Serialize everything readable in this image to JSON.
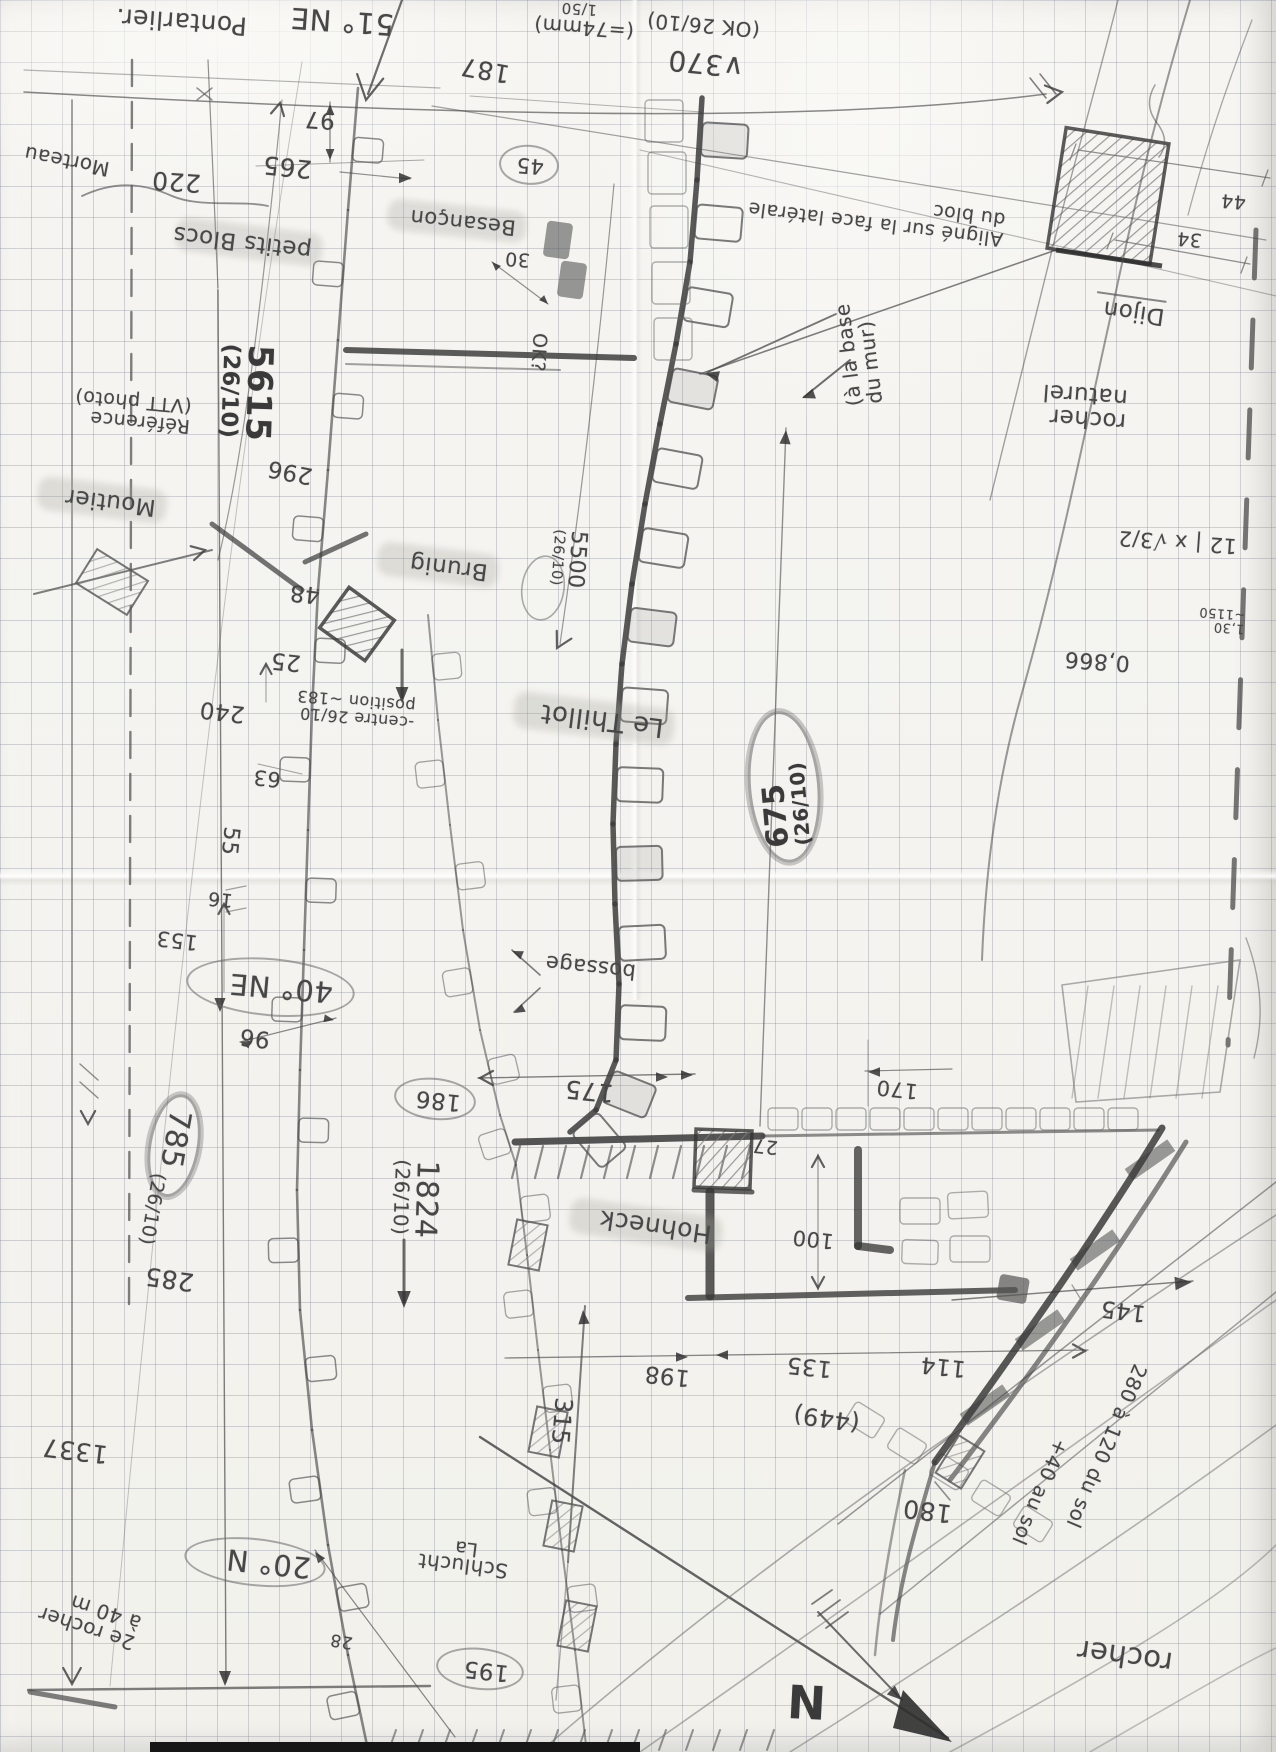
{
  "page": {
    "width": 1276,
    "height": 1752,
    "paper_color": "#f4f3ef",
    "grid_color": "rgba(122,130,146,0.32)",
    "pencil_color": "#474747",
    "description_labels_language": "fr"
  },
  "labels": [
    {
      "name": "label-pontarlier",
      "text": "Pontarlier.",
      "x": 52,
      "y": 6,
      "w": 195,
      "rot": 184,
      "size": 25
    },
    {
      "name": "label-bearing-51ne",
      "text": "51° NE",
      "x": 286,
      "y": 6,
      "w": 108,
      "rot": 184,
      "size": 29
    },
    {
      "name": "dim-187",
      "text": "187",
      "x": 452,
      "y": 56,
      "w": 58,
      "rot": 190,
      "size": 25
    },
    {
      "name": "dim-97",
      "text": "97",
      "x": 293,
      "y": 106,
      "w": 42,
      "rot": 184,
      "size": 23
    },
    {
      "name": "dim-265",
      "text": "265",
      "x": 252,
      "y": 153,
      "w": 60,
      "rot": 186,
      "size": 25
    },
    {
      "name": "dim-220",
      "text": "220",
      "x": 143,
      "y": 168,
      "w": 58,
      "rot": 184,
      "size": 25
    },
    {
      "name": "label-morteau",
      "text": "Morteau",
      "x": 18,
      "y": 150,
      "w": 92,
      "rot": 191,
      "size": 20
    },
    {
      "name": "label-petits-blocs",
      "text": "petits Blocs",
      "x": 180,
      "y": 230,
      "w": 126,
      "rot": 187,
      "size": 23,
      "cls": "hl"
    },
    {
      "name": "label-besancon",
      "text": "Besançon",
      "x": 392,
      "y": 210,
      "w": 118,
      "rot": 186,
      "size": 21,
      "cls": "hl"
    },
    {
      "name": "note-scale-150",
      "text": "1/50",
      "x": 549,
      "y": 0,
      "w": 48,
      "rot": 184,
      "size": 15
    },
    {
      "name": "note-74mm",
      "text": "(=74mm)",
      "x": 522,
      "y": 17,
      "w": 112,
      "rot": 184,
      "size": 20
    },
    {
      "name": "note-ok-2610",
      "text": "(OK 26/10)",
      "x": 628,
      "y": 14,
      "w": 132,
      "rot": 185,
      "size": 20
    },
    {
      "name": "dim-370",
      "text": "∨370",
      "x": 646,
      "y": 48,
      "w": 98,
      "rot": 186,
      "size": 28
    },
    {
      "name": "dim-45",
      "text": "45",
      "x": 499,
      "y": 145,
      "w": 30,
      "rot": 184,
      "size": 21,
      "cls": "circ"
    },
    {
      "name": "dim-30",
      "text": "30",
      "x": 494,
      "y": 248,
      "w": 36,
      "rot": 184,
      "size": 19
    },
    {
      "name": "note-aligne",
      "lines": [
        "Aligné sur la face latérale",
        "du bloc"
      ],
      "x": 775,
      "y": 195,
      "w": 230,
      "rot": 187,
      "size": 19
    },
    {
      "name": "note-a-la-base",
      "lines": [
        "(à la base",
        "du mur)"
      ],
      "x": 795,
      "y": 322,
      "w": 125,
      "rot": -97,
      "size": 20
    },
    {
      "name": "label-dijon",
      "text": "Dijon",
      "x": 1095,
      "y": 296,
      "w": 70,
      "rot": 188,
      "size": 23,
      "cls": "und"
    },
    {
      "name": "dim-44",
      "text": "44",
      "x": 1212,
      "y": 190,
      "w": 34,
      "rot": 185,
      "size": 19
    },
    {
      "name": "dim-34",
      "text": "34",
      "x": 1168,
      "y": 228,
      "w": 34,
      "rot": 185,
      "size": 19
    },
    {
      "name": "label-rocher-naturel",
      "lines": [
        "rocher",
        "naturel"
      ],
      "x": 992,
      "y": 380,
      "w": 135,
      "rot": 184,
      "size": 23
    },
    {
      "name": "calc-sqrt3-over-2",
      "text": "12 | x √3/2",
      "x": 1112,
      "y": 530,
      "w": 125,
      "rot": 184,
      "size": 21
    },
    {
      "name": "calc-1150",
      "lines": [
        "1,30",
        "~1150"
      ],
      "x": 1185,
      "y": 606,
      "w": 60,
      "rot": 184,
      "size": 13
    },
    {
      "name": "calc-0866",
      "text": "0,866",
      "x": 1055,
      "y": 648,
      "w": 75,
      "rot": 184,
      "size": 22
    },
    {
      "name": "dim-5615",
      "lines": [
        "5615",
        "(26/10)"
      ],
      "x": 186,
      "y": 375,
      "w": 120,
      "rot": 92,
      "size": 34,
      "cls": "b",
      "sub": true
    },
    {
      "name": "note-reference-photo",
      "lines": [
        "Référence",
        "(VTT photo)"
      ],
      "x": 56,
      "y": 390,
      "w": 135,
      "rot": 185,
      "size": 19
    },
    {
      "name": "dim-296",
      "text": "296",
      "x": 258,
      "y": 458,
      "w": 55,
      "rot": 191,
      "size": 23
    },
    {
      "name": "label-moutier",
      "text": "Moutier",
      "x": 42,
      "y": 488,
      "w": 108,
      "rot": 187,
      "size": 23,
      "cls": "hl"
    },
    {
      "name": "dim-48",
      "text": "48",
      "x": 280,
      "y": 580,
      "w": 40,
      "rot": 186,
      "size": 23
    },
    {
      "name": "label-brunig",
      "text": "Brunig",
      "x": 382,
      "y": 553,
      "w": 100,
      "rot": 187,
      "size": 23,
      "cls": "hl"
    },
    {
      "name": "dim-25",
      "text": "25",
      "x": 263,
      "y": 648,
      "w": 38,
      "rot": 186,
      "size": 23
    },
    {
      "name": "note-centre-position",
      "lines": [
        "-centre 26/10",
        "position ~183"
      ],
      "x": 290,
      "y": 692,
      "w": 125,
      "rot": 185,
      "size": 16
    },
    {
      "name": "dim-240",
      "text": "240",
      "x": 190,
      "y": 698,
      "w": 55,
      "rot": 187,
      "size": 23
    },
    {
      "name": "dim-63",
      "text": "63",
      "x": 243,
      "y": 766,
      "w": 38,
      "rot": 186,
      "size": 21
    },
    {
      "name": "dim-55",
      "text": "55",
      "x": 205,
      "y": 838,
      "w": 46,
      "rot": 96,
      "size": 22
    },
    {
      "name": "dim-16",
      "text": "16",
      "x": 199,
      "y": 888,
      "w": 34,
      "rot": 186,
      "size": 19
    },
    {
      "name": "dim-153",
      "text": "153",
      "x": 146,
      "y": 928,
      "w": 52,
      "rot": 187,
      "size": 21
    },
    {
      "name": "note-ok-q",
      "text": "OK?",
      "x": 508,
      "y": 352,
      "w": 58,
      "rot": 94,
      "size": 19
    },
    {
      "name": "dim-5500",
      "lines": [
        "5500",
        "(26/10)"
      ],
      "x": 519,
      "y": 559,
      "w": 96,
      "rot": 94,
      "size": 22,
      "sub": true
    },
    {
      "name": "label-le-thillot",
      "text": "Le Thillot",
      "x": 518,
      "y": 705,
      "w": 140,
      "rot": 187,
      "size": 26,
      "cls": "hl"
    },
    {
      "name": "dim-675",
      "lines": [
        "675",
        "(26/10)"
      ],
      "x": 708,
      "y": 751,
      "w": 120,
      "rot": -95,
      "size": 30,
      "cls": "circ heavy b",
      "sub": true
    },
    {
      "name": "dim-96",
      "text": "96",
      "x": 228,
      "y": 1024,
      "w": 42,
      "rot": 187,
      "size": 23
    },
    {
      "name": "label-bearing-40ne",
      "text": "40° NE",
      "x": 186,
      "y": 958,
      "w": 125,
      "rot": 185,
      "size": 29,
      "cls": "circ big"
    },
    {
      "name": "dim-785",
      "text": "785",
      "x": 122,
      "y": 1120,
      "w": 72,
      "rot": 100,
      "size": 30,
      "cls": "circ heavy"
    },
    {
      "name": "dim-785-date",
      "text": "(26/10)",
      "x": 108,
      "y": 1205,
      "w": 85,
      "rot": 100,
      "size": 19
    },
    {
      "name": "dim-285",
      "text": "285",
      "x": 134,
      "y": 1265,
      "w": 60,
      "rot": 188,
      "size": 25
    },
    {
      "name": "dim-186",
      "text": "186",
      "x": 394,
      "y": 1078,
      "w": 52,
      "rot": 186,
      "size": 23,
      "cls": "circ"
    },
    {
      "name": "note-bossage",
      "text": "bossage",
      "x": 536,
      "y": 955,
      "w": 100,
      "rot": 186,
      "size": 21
    },
    {
      "name": "dim-175",
      "text": "175",
      "x": 552,
      "y": 1077,
      "w": 62,
      "rot": 186,
      "size": 25
    },
    {
      "name": "dim-1824",
      "lines": [
        "1824",
        "(26/10)"
      ],
      "x": 355,
      "y": 1194,
      "w": 120,
      "rot": 92,
      "size": 30,
      "sub": true
    },
    {
      "name": "label-hohneck",
      "text": "Hohneck",
      "x": 574,
      "y": 1212,
      "w": 132,
      "rot": 188,
      "size": 25,
      "cls": "hl"
    },
    {
      "name": "dim-27",
      "text": "27",
      "x": 744,
      "y": 1135,
      "w": 34,
      "rot": 186,
      "size": 19
    },
    {
      "name": "dim-170",
      "text": "170",
      "x": 866,
      "y": 1077,
      "w": 52,
      "rot": 186,
      "size": 21
    },
    {
      "name": "dim-100",
      "text": "100",
      "x": 784,
      "y": 1227,
      "w": 50,
      "rot": 186,
      "size": 21
    },
    {
      "name": "dim-198",
      "text": "198",
      "x": 634,
      "y": 1362,
      "w": 56,
      "rot": 186,
      "size": 23
    },
    {
      "name": "dim-135",
      "text": "135",
      "x": 776,
      "y": 1353,
      "w": 56,
      "rot": 186,
      "size": 23
    },
    {
      "name": "dim-114",
      "text": "114",
      "x": 914,
      "y": 1353,
      "w": 52,
      "rot": 186,
      "size": 23
    },
    {
      "name": "dim-449",
      "text": "(449)",
      "x": 785,
      "y": 1405,
      "w": 75,
      "rot": 188,
      "size": 24
    },
    {
      "name": "dim-315",
      "text": "315",
      "x": 534,
      "y": 1412,
      "w": 54,
      "rot": 95,
      "size": 24
    },
    {
      "name": "dim-145",
      "text": "145",
      "x": 1090,
      "y": 1297,
      "w": 56,
      "rot": 187,
      "size": 23
    },
    {
      "name": "note-280-du-sol",
      "text": "280 à 120 du sol",
      "x": 1012,
      "y": 1440,
      "w": 185,
      "rot": 113,
      "size": 20
    },
    {
      "name": "note-40-au-sol",
      "text": "+40 au sol",
      "x": 975,
      "y": 1487,
      "w": 125,
      "rot": 113,
      "size": 20
    },
    {
      "name": "dim-180",
      "text": "180",
      "x": 894,
      "y": 1497,
      "w": 58,
      "rot": 187,
      "size": 25
    },
    {
      "name": "label-rocher",
      "text": "rocher",
      "x": 1028,
      "y": 1638,
      "w": 145,
      "rot": 188,
      "size": 29
    },
    {
      "name": "label-bearing-20n",
      "text": "20° N",
      "x": 184,
      "y": 1538,
      "w": 112,
      "rot": 186,
      "size": 29,
      "cls": "circ"
    },
    {
      "name": "note-2e-rocher",
      "lines": [
        "2e rocher",
        "à 40 m"
      ],
      "x": 25,
      "y": 1595,
      "w": 115,
      "rot": 198,
      "size": 20
    },
    {
      "name": "dim-28",
      "text": "28",
      "x": 317,
      "y": 1630,
      "w": 36,
      "rot": 190,
      "size": 17
    },
    {
      "name": "dim-195",
      "text": "195",
      "x": 436,
      "y": 1648,
      "w": 58,
      "rot": 186,
      "size": 23,
      "cls": "circ"
    },
    {
      "name": "label-la-schlucht-1",
      "text": "La",
      "x": 444,
      "y": 1537,
      "w": 34,
      "rot": 187,
      "size": 19
    },
    {
      "name": "label-la-schlucht-2",
      "text": "Schlucht",
      "x": 416,
      "y": 1555,
      "w": 92,
      "rot": 187,
      "size": 20
    },
    {
      "name": "dim-1337",
      "text": "1337",
      "x": 38,
      "y": 1437,
      "w": 70,
      "rot": 187,
      "size": 25
    },
    {
      "name": "compass-north",
      "text": "N",
      "x": 766,
      "y": 1676,
      "w": 60,
      "rot": 183,
      "size": 46,
      "cls": "b"
    }
  ]
}
